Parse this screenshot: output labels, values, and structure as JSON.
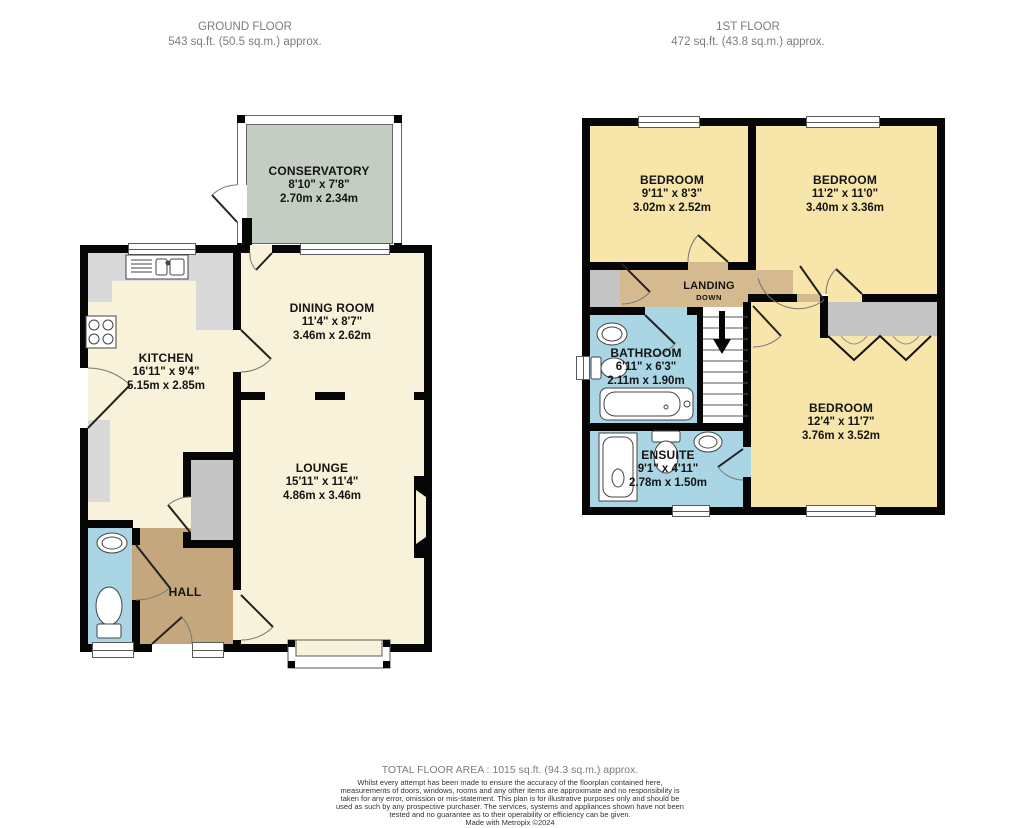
{
  "floors": [
    {
      "id": "ground",
      "title": "GROUND FLOOR",
      "area": "543 sq.ft. (50.5 sq.m.) approx.",
      "rooms": [
        {
          "name": "CONSERVATORY",
          "imperial": "8'10\"  x 7'8\"",
          "metric": "2.70m  x 2.34m"
        },
        {
          "name": "KITCHEN",
          "imperial": "16'11\"  x 9'4\"",
          "metric": "5.15m  x 2.85m"
        },
        {
          "name": "DINING ROOM",
          "imperial": "11'4\"  x 8'7\"",
          "metric": "3.46m  x 2.62m"
        },
        {
          "name": "LOUNGE",
          "imperial": "15'11\"  x 11'4\"",
          "metric": "4.86m  x 3.46m"
        },
        {
          "name": "HALL"
        }
      ]
    },
    {
      "id": "first",
      "title": "1ST FLOOR",
      "area": "472 sq.ft. (43.8 sq.m.) approx.",
      "rooms": [
        {
          "name": "BEDROOM",
          "imperial": "9'11\"  x 8'3\"",
          "metric": "3.02m  x 2.52m"
        },
        {
          "name": "BEDROOM",
          "imperial": "11'2\"  x 11'0\"",
          "metric": "3.40m  x 3.36m"
        },
        {
          "name": "LANDING",
          "sub": "DOWN"
        },
        {
          "name": "BATHROOM",
          "imperial": "6'11\"  x 6'3\"",
          "metric": "2.11m  x 1.90m"
        },
        {
          "name": "ENSUITE",
          "imperial": "9'1\"  x 4'11\"",
          "metric": "2.78m  x 1.50m"
        },
        {
          "name": "BEDROOM",
          "imperial": "12'4\"  x 11'7\"",
          "metric": "3.76m  x 3.52m"
        }
      ]
    }
  ],
  "footer": {
    "total": "TOTAL FLOOR AREA : 1015 sq.ft. (94.3 sq.m.) approx.",
    "disclaimer": "Whilst every attempt has been made to ensure the accuracy of the floorplan contained here, measurements of doors, windows, rooms and any other items are approximate and no responsibility is taken for any error, omission or mis-statement. This plan is for illustrative purposes only and should be used as such by any prospective purchaser. The services, systems and appliances shown have not been tested and no guarantee as to their operability or efficiency can be given.",
    "credit": "Made with Metropix ©2024"
  },
  "colors": {
    "wall": "#060606",
    "room_cream": "#f8f2da",
    "bedroom_yellow": "#f7e5a9",
    "conservatory_green": "#c4cdc1",
    "wet_room_blue": "#a9d5e4",
    "hall_tan": "#c5a77d",
    "landing_tan": "#d5ba90",
    "counter_grey": "#d9d9d9",
    "cupboard_grey": "#c4c4c4",
    "header_text": "#7c7c7c",
    "label_text": "#141414"
  }
}
